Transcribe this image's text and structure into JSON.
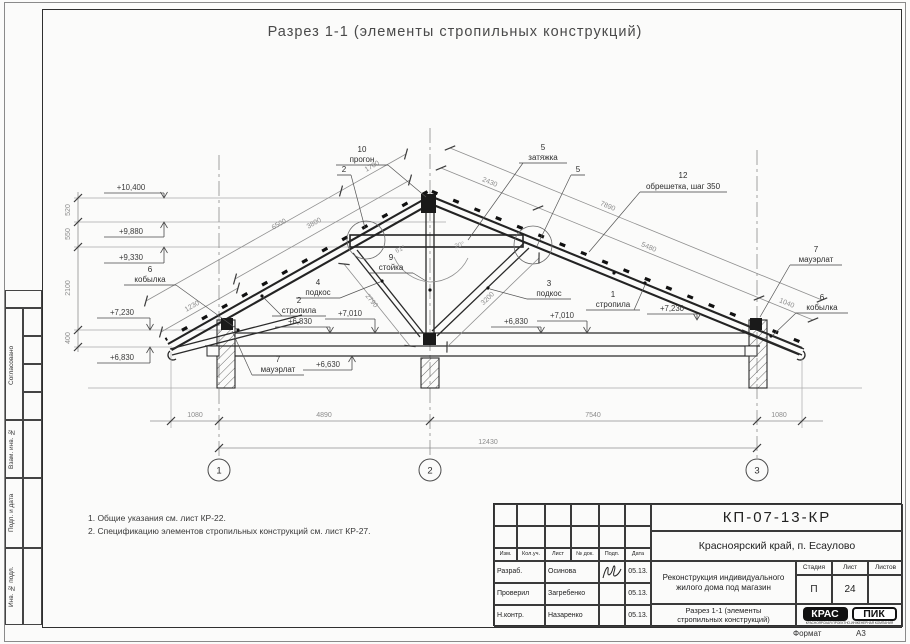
{
  "title": "Разрез 1-1 (элементы стропильных конструкций)",
  "notes": {
    "line1": "1. Общие указания см. лист КР-22.",
    "line2": "2. Спецификацию элементов стропильных конструкций см. лист КР-27."
  },
  "side_stamp": {
    "soglasovano": "Согласовано",
    "vzam": "Взам. инв. №",
    "podp": "Подп. и дата",
    "inv": "Инв. № подл."
  },
  "elevations": {
    "left_10400": "+10,400",
    "left_9880": "+9,880",
    "left_9330": "+9,330",
    "left_7230": "+7,230",
    "left_6830": "+6,830",
    "mid_left_6830": "+6,830",
    "mid_left_7010": "+7,010",
    "mid_6630": "+6,630",
    "mid_right_6830": "+6,830",
    "mid_right_7010": "+7,010",
    "right_7230": "+7,230"
  },
  "dims": {
    "v520": "520",
    "v550": "550",
    "v2100": "2100",
    "v400": "400",
    "slope_left_1700": "1700",
    "slope_left_6500": "6500",
    "slope_left_3800": "3800",
    "slope_left_1230": "1230",
    "slope_right_2430": "2430",
    "slope_right_7890": "7890",
    "slope_right_5480": "5480",
    "slope_right_1040": "1040",
    "strut_left_2790": "2790",
    "strut_right_3200": "3200",
    "angle_left": "61°",
    "angle_right": "20°",
    "bottom_1080_left": "1080",
    "bottom_4890": "4890",
    "bottom_7540": "7540",
    "bottom_1080_right": "1080",
    "bottom_total": "12430"
  },
  "parts": {
    "progon_num": "10",
    "progon": "прогон",
    "rafter_apex_num": "2",
    "zatyazhka_num": "5",
    "zatyazhka": "затяжка",
    "zatyazhka_num2": "5",
    "obreshetka_num": "12",
    "obreshetka": "обрешетка, шаг 350",
    "stoyka_num": "9",
    "stoyka": "стойка",
    "podkos_left_num": "4",
    "podkos_left": "подкос",
    "strop_left_num": "2",
    "strop_left": "стропила",
    "podkos_right_num": "3",
    "podkos_right": "подкос",
    "strop_right_num": "1",
    "strop_right": "стропила",
    "mauerlat_left_num": "7",
    "mauerlat_left": "мауэрлат",
    "mauerlat_right_num": "7",
    "mauerlat_right": "мауэрлат",
    "kobylka_left_num": "6",
    "kobylka_left": "кобылка",
    "kobylka_right_num": "6",
    "kobylka_right": "кобылка"
  },
  "axes": {
    "a1": "1",
    "a2": "2",
    "a3": "3"
  },
  "title_block": {
    "doc_number": "КП-07-13-КР",
    "location": "Красноярский край, п. Есаулово",
    "project_line1": "Реконструкция индивидуального",
    "project_line2": "жилого дома под магазин",
    "sheet_title_line1": "Разрез 1-1 (элементы",
    "sheet_title_line2": "стропильных конструкций)",
    "col_izm": "Изм.",
    "col_koluch": "Кол.уч.",
    "col_list": "Лист",
    "col_ndok": "№ док.",
    "col_podp": "Подп.",
    "col_data": "Дата",
    "row1_role": "Разраб.",
    "row1_name": "Осинова",
    "row1_date": "05.13.",
    "row2_role": "Проверил",
    "row2_name": "Загребенко",
    "row2_date": "05.13.",
    "row3_role": "Н.контр.",
    "row3_name": "Назаренко",
    "row3_date": "05.13.",
    "stage_label": "Стадия",
    "sheet_label": "Лист",
    "sheets_label": "Листов",
    "stage": "П",
    "sheet_num": "24",
    "logo_left": "КРАС",
    "logo_right": "ПИК",
    "logo_sub": "КРАСНОЯРСКАЯ ПРОЕКТНО-ИНЖЕНЕРНАЯ КОМПАНИЯ",
    "format_label": "Формат",
    "format_value": "А3"
  }
}
